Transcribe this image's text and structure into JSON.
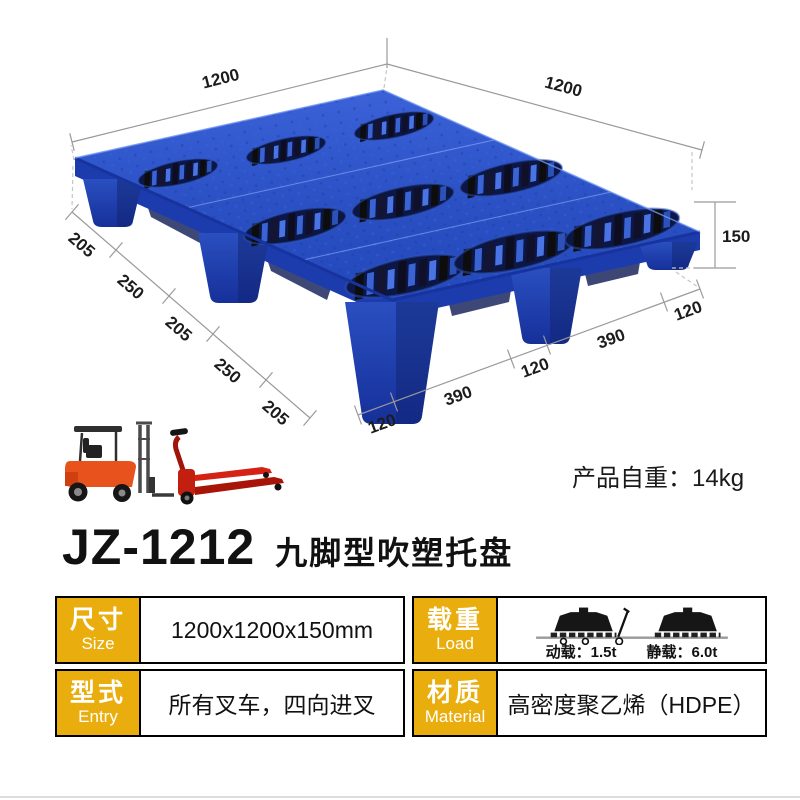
{
  "product": {
    "model": "JZ-1212",
    "name": "九脚型吹塑托盘",
    "weight_label": "产品自重：14kg"
  },
  "diagram": {
    "width_left": "1200",
    "width_right": "1200",
    "height": "150",
    "left_edge_segments": [
      "205",
      "250",
      "205",
      "250",
      "205"
    ],
    "bottom_edge_segments": [
      "120",
      "390",
      "120",
      "390",
      "120"
    ]
  },
  "spec_table": {
    "size": {
      "label_cn": "尺寸",
      "label_en": "Size",
      "value": "1200x1200x150mm"
    },
    "load": {
      "label_cn": "载重",
      "label_en": "Load",
      "dynamic_label": "动载：1.5t",
      "static_label": "静载：6.0t"
    },
    "entry": {
      "label_cn": "型式",
      "label_en": "Entry",
      "value": "所有叉车，四向进叉"
    },
    "material": {
      "label_cn": "材质",
      "label_en": "Material",
      "value": "高密度聚乙烯（HDPE）"
    }
  },
  "icons": {
    "forklift": "forklift-photo",
    "pallet_jack": "pallet-jack-photo",
    "dynamic_load": "dynamic-load-icon",
    "static_load": "static-load-icon"
  },
  "colors": {
    "pallet_blue": "#2A50C4",
    "pallet_blue_dark": "#16309A",
    "recess_dark": "#0B1747",
    "header_yellow": "#E9AE0E",
    "header_text": "#FFFFFF",
    "table_border": "#000000",
    "dim_line": "#9A9A9A",
    "text": "#1A1A1A",
    "forklift_orange": "#E8521D",
    "jack_red": "#C92012"
  }
}
